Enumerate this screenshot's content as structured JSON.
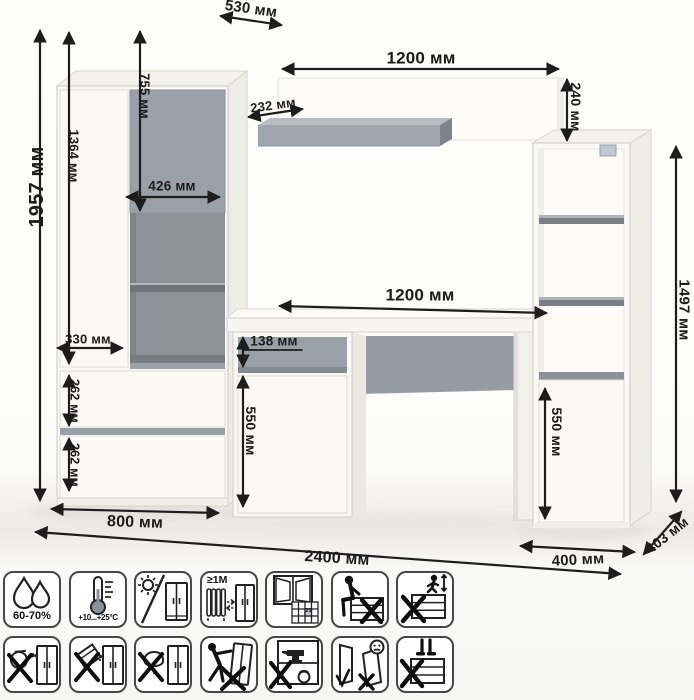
{
  "title": "Furniture wall unit with desk — dimensional drawing",
  "units": "мм",
  "dimensions": {
    "wardrobe_depth": "530 мм",
    "total_height": "1957 мм",
    "left_door_height": "1364 мм",
    "grey_door_height": "755 мм",
    "grey_door_width": "426 мм",
    "niche_width": "330 мм",
    "upper_drawer_height": "262 мм",
    "lower_drawer_height": "262 мм",
    "wardrobe_width": "800 мм",
    "wall_panel_width": "1200 мм",
    "wall_panel_height": "240 мм",
    "wall_shelf_depth": "232 мм",
    "desk_width": "1200 мм",
    "desk_drawer_height": "138 мм",
    "desk_door_height": "550 мм",
    "bookcase_height": "1497 мм",
    "bookcase_door_height": "550 мм",
    "bookcase_width": "400 мм",
    "bookcase_depth": "403 мм",
    "total_width": "2400 мм"
  },
  "care_icons": {
    "row1": [
      {
        "name": "humidity-range-icon",
        "text": "60-70%"
      },
      {
        "name": "temperature-range-icon",
        "text": "+10...+25°C"
      },
      {
        "name": "no-direct-sunlight-icon",
        "text": ""
      },
      {
        "name": "distance-from-heaters-icon",
        "text": "≥1M"
      },
      {
        "name": "ventilate-room-icon",
        "text": "21"
      },
      {
        "name": "no-sitting-on-furniture-icon",
        "text": ""
      },
      {
        "name": "no-jumping-on-furniture-icon",
        "text": ""
      }
    ],
    "row2": [
      {
        "name": "no-hot-objects-icon",
        "text": ""
      },
      {
        "name": "no-abrasive-powder-icon",
        "text": ""
      },
      {
        "name": "no-wet-cleaning-icon",
        "text": ""
      },
      {
        "name": "no-dragging-furniture-icon",
        "text": ""
      },
      {
        "name": "no-overloading-icon",
        "text": ""
      },
      {
        "name": "door-adjustment-warning-icon",
        "text": ""
      },
      {
        "name": "no-standing-on-furniture-icon",
        "text": ""
      }
    ]
  },
  "colors": {
    "accent_grey": "#9aa0a8",
    "furniture_white": "#f9f8f4",
    "dimension_line": "#1d1d1d"
  }
}
